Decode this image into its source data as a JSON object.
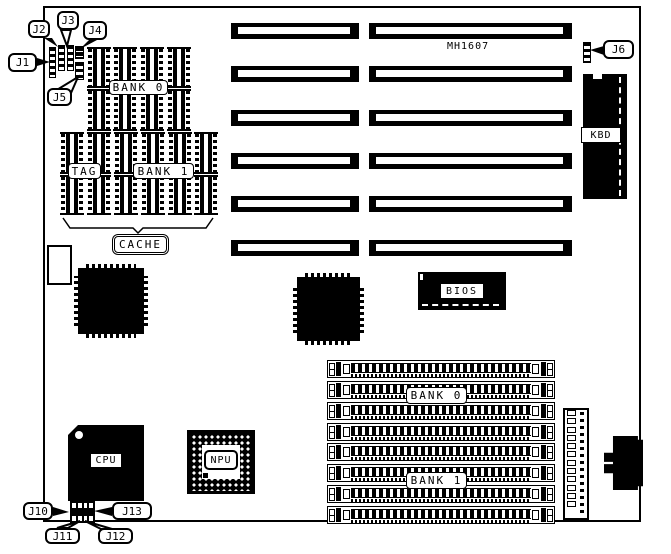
{
  "colors": {
    "ink": "#000000",
    "paper": "#ffffff"
  },
  "silkscreen_model": "MH1607",
  "labels": {
    "dip_bank0": "BANK 0",
    "tag": "TAG",
    "dip_bank1": "BANK 1",
    "cache": "CACHE",
    "bios": "BIOS",
    "kbd": "KBD",
    "cpu": "CPU",
    "npu": "NPU",
    "simm_bank0": "BANK 0",
    "simm_bank1": "BANK 1"
  },
  "callouts": {
    "j1": "J1",
    "j2": "J2",
    "j3": "J3",
    "j4": "J4",
    "j5": "J5",
    "j6": "J6",
    "j10": "J10",
    "j11": "J11",
    "j12": "J12",
    "j13": "J13"
  },
  "counts": {
    "isa_slot_rows": 6,
    "isa_slot_columns": 2,
    "simm_sockets": 8,
    "dip_bank0_chips": 8,
    "dip_cache_chips": 12,
    "power_header_pins": 12
  }
}
